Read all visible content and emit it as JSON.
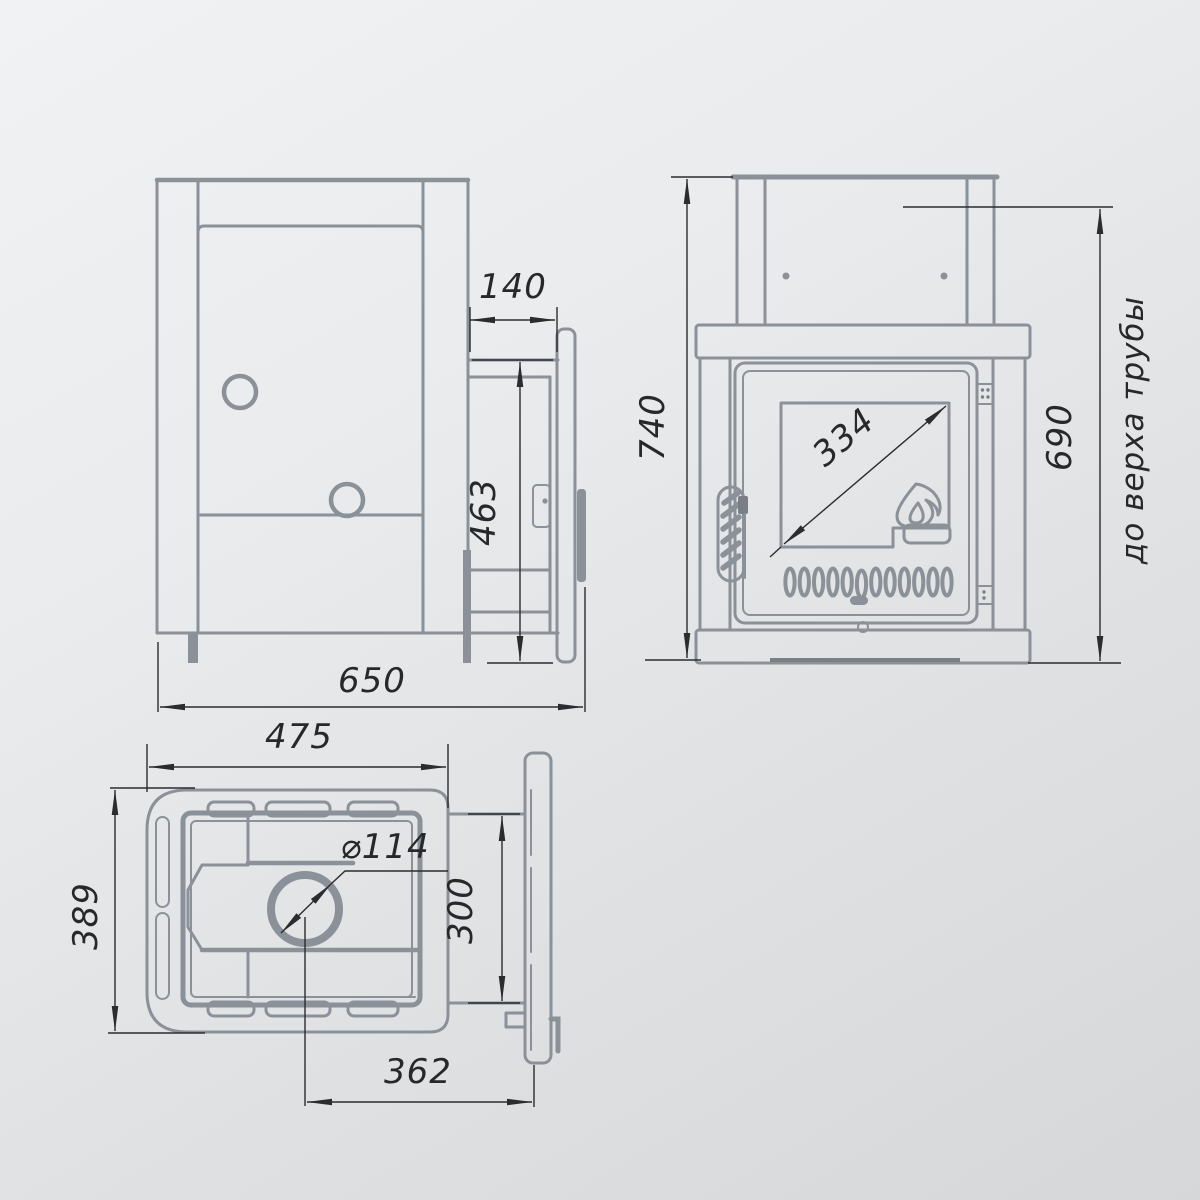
{
  "drawing_type": "stove technical drawing, three orthographic views",
  "side_view": {
    "dims": {
      "tunnel_depth": "140",
      "door_unit_height": "463",
      "total_depth": "650"
    }
  },
  "front_view": {
    "dims": {
      "total_height": "740",
      "glass_diagonal": "334",
      "pipe_top_height": "690"
    },
    "pipe_note": "до верха трубы"
  },
  "top_view": {
    "dims": {
      "body_width": "475",
      "body_depth": "389",
      "pipe_diameter": "⌀114",
      "tunnel_width": "300",
      "pipe_center_offset": "362"
    }
  },
  "colors": {
    "structure_line": "#8b9198",
    "dimension_line": "#2a2c2f",
    "background_light": "#f1f2f4",
    "background_dark": "#d5d7d9"
  }
}
